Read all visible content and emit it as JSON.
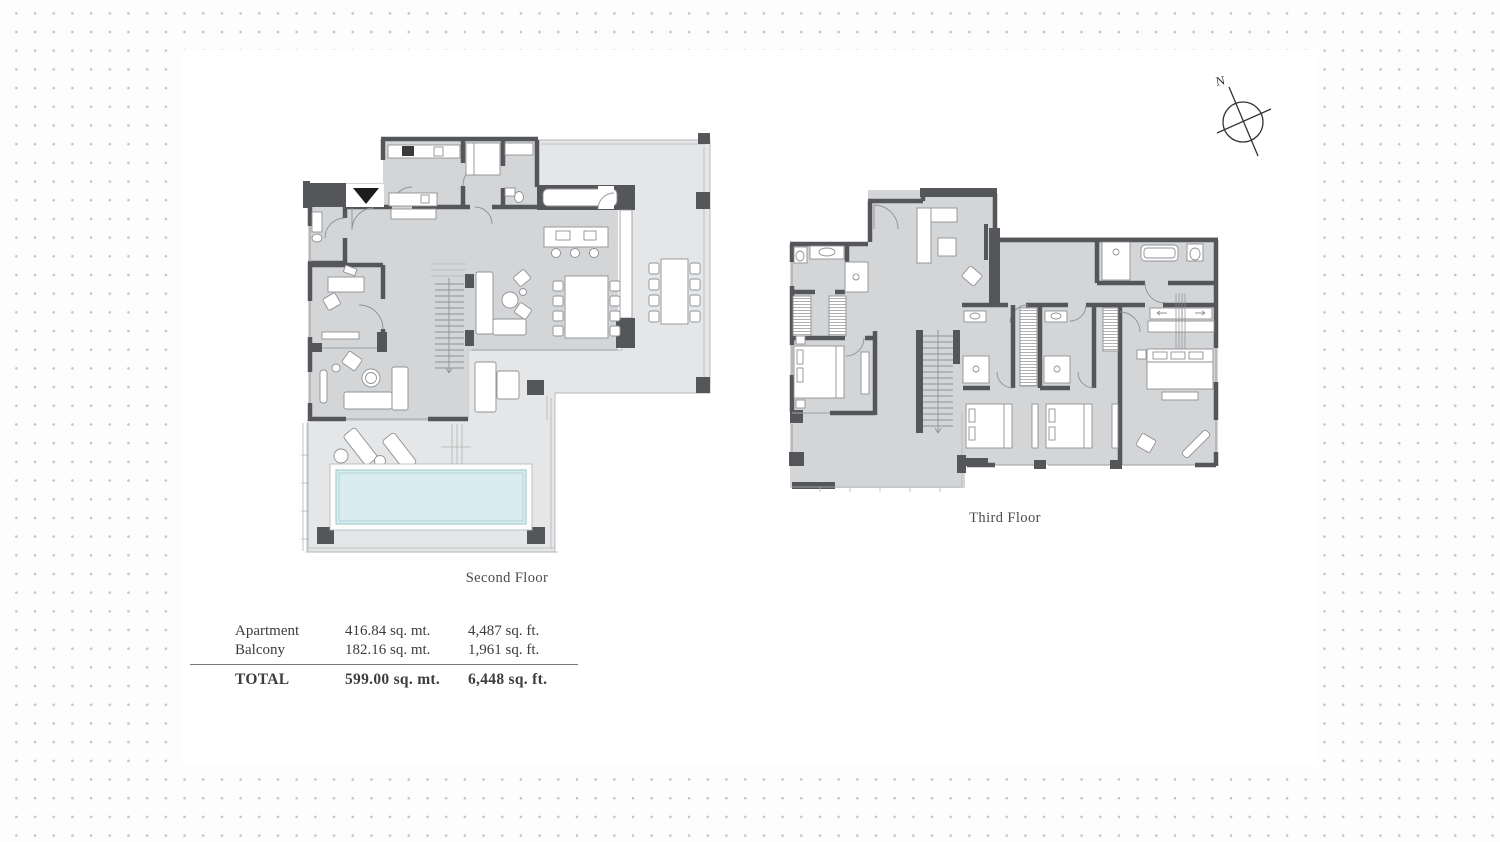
{
  "compass": {
    "label": "N"
  },
  "plans": [
    {
      "name": "second-floor",
      "label": "Second Floor"
    },
    {
      "name": "third-floor",
      "label": "Third Floor"
    }
  ],
  "area_table": {
    "rows": [
      {
        "label": "Apartment",
        "metric": "416.84 sq. mt.",
        "imperial": "4,487 sq. ft."
      },
      {
        "label": "Balcony",
        "metric": "182.16 sq. mt.",
        "imperial": "1,961 sq. ft."
      }
    ],
    "total": {
      "label": "TOTAL",
      "metric": "599.00 sq. mt.",
      "imperial": "6,448 sq. ft."
    }
  },
  "colors": {
    "wall": "#55565a",
    "interior": "#d4d5d7",
    "terrace": "#e5e6e7",
    "pool": "#d9edf1",
    "line": "#8f9194",
    "text": "#3f3f41",
    "dot": "#c3c3c3",
    "panel": "#ffffff",
    "entry": "#1c1c1c"
  }
}
